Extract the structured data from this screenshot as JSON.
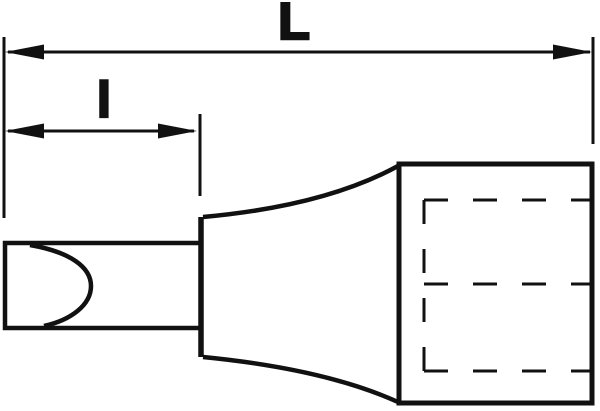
{
  "diagram": {
    "kind": "technical-line-drawing",
    "subject": "slotted screwdriver bit socket, side view",
    "dimension_labels": {
      "overall_length": "L",
      "blade_length": "l"
    },
    "colors": {
      "line": "#111111",
      "background": "#ffffff"
    }
  }
}
